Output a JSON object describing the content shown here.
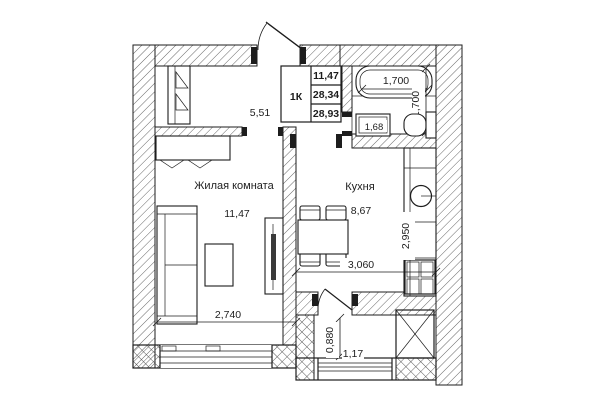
{
  "plan": {
    "info_table": {
      "type": "1К",
      "values": [
        "11,47",
        "28,34",
        "28,93"
      ]
    },
    "rooms": {
      "hall": {
        "area": "5,51"
      },
      "living": {
        "name": "Жилая комната",
        "area": "11,47"
      },
      "kitchen": {
        "name": "Кухня",
        "area": "8,67"
      },
      "balcony": {
        "area": "1,17"
      }
    },
    "dims": {
      "tub_width": "1,700",
      "bath_depth": "1,700",
      "bath_fixture": "1,68",
      "living_width": "2,740",
      "kitchen_width": "3,060",
      "kitchen_depth": "2,950",
      "balcony_depth": "0,880"
    },
    "colors": {
      "line": "#1d1d1d",
      "bg": "#ffffff",
      "hatch": "#555555",
      "tile": "#9a9a9a"
    }
  }
}
